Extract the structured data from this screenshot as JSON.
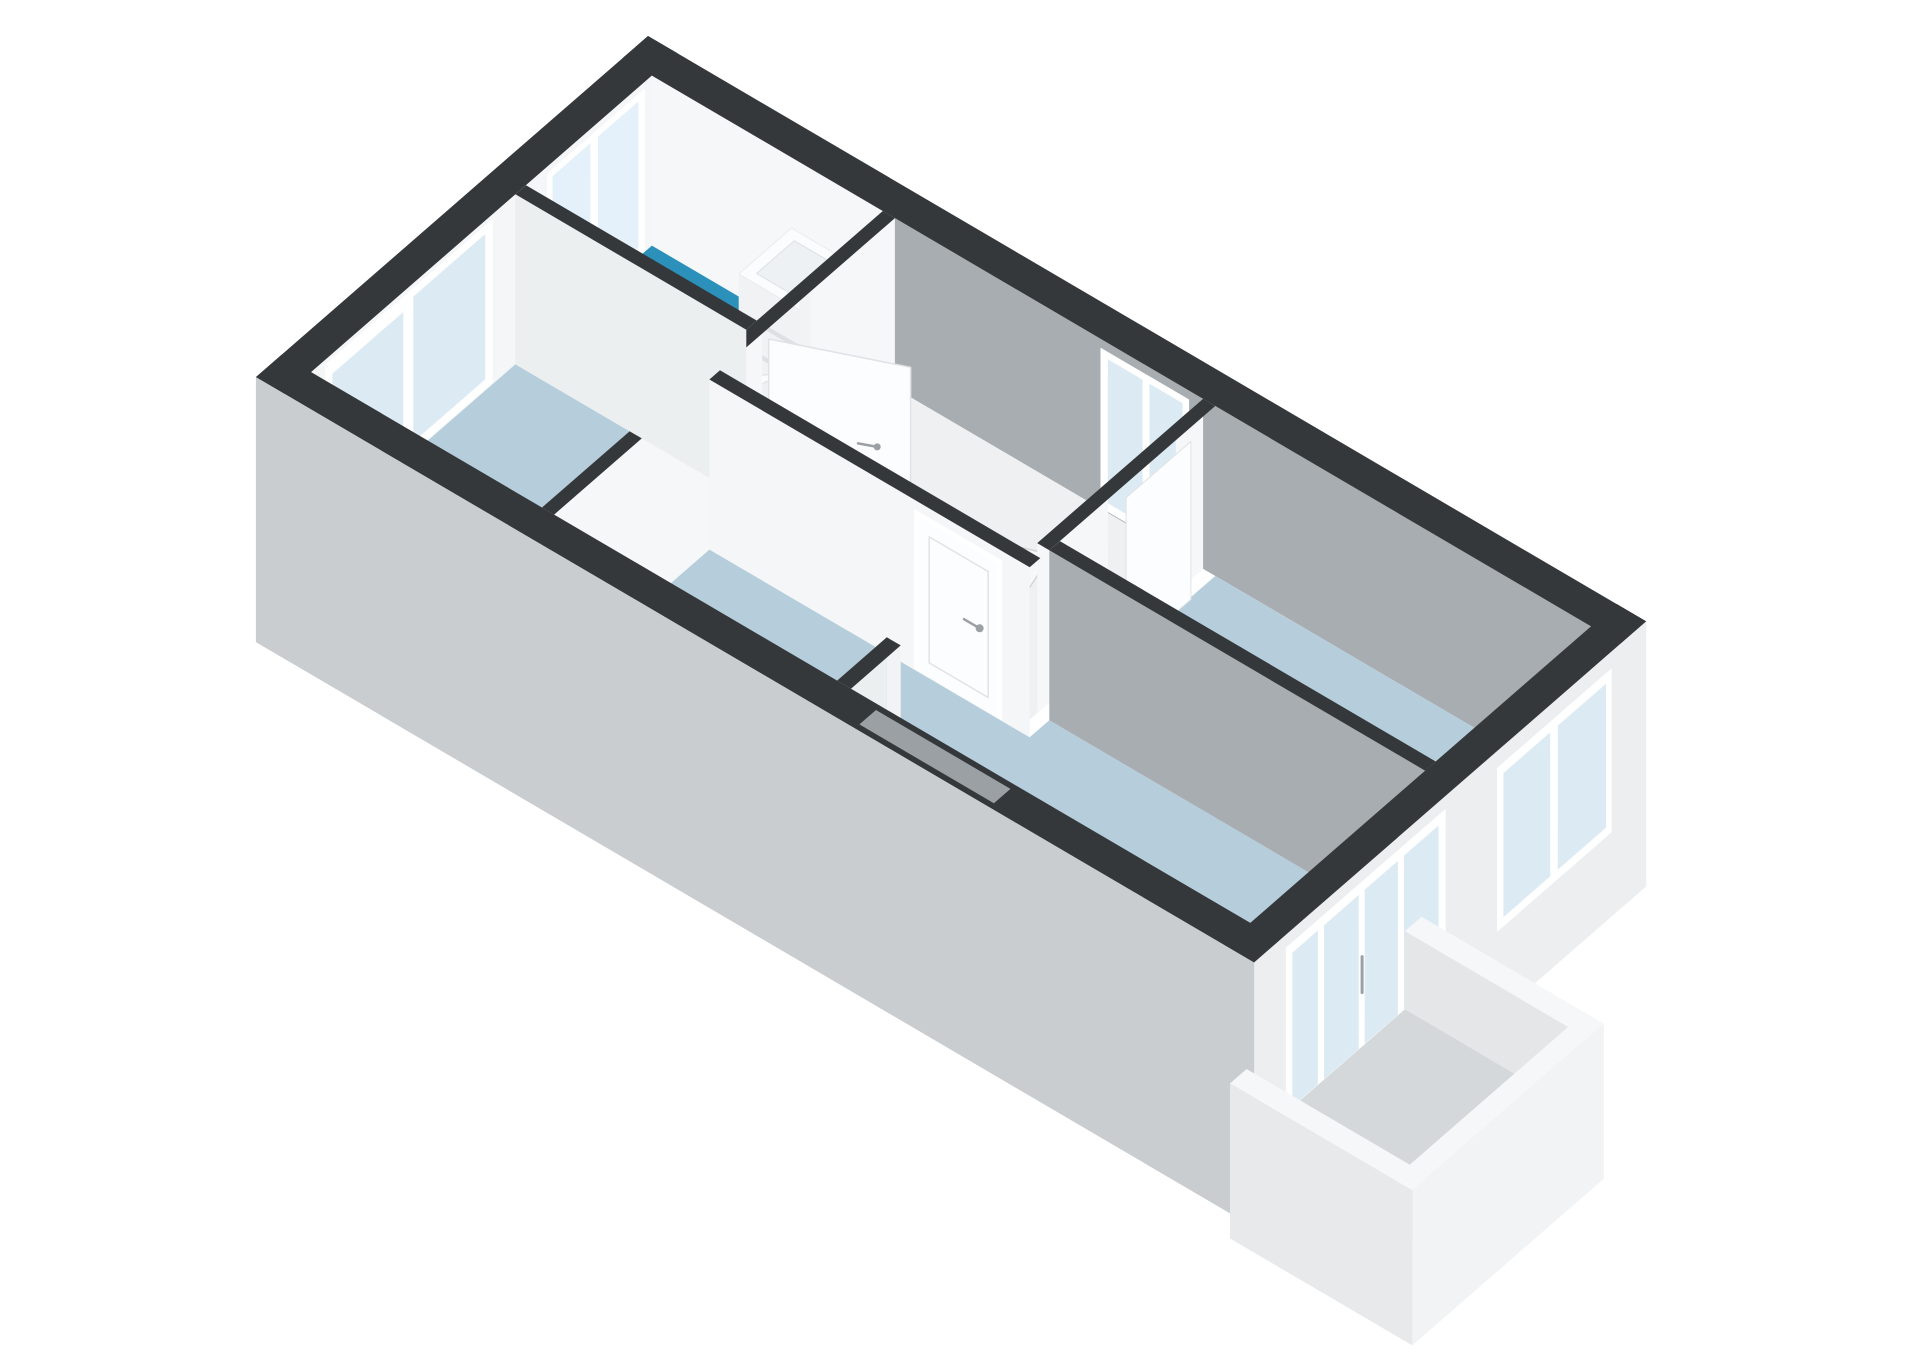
{
  "page": {
    "background": "#FFFFFF",
    "content_type": "3d-floorplan-render"
  },
  "floorplan": {
    "view": "axonometric-3d-cutaway",
    "rooms": [
      {
        "name": "bathroom",
        "floor_color_key": "floor_bathroom"
      },
      {
        "name": "landing-hall",
        "floor_color_key": "floor_hall"
      },
      {
        "name": "room-left",
        "floor_color_key": "floor_room"
      },
      {
        "name": "room-right",
        "floor_color_key": "floor_room"
      },
      {
        "name": "room-bottom",
        "floor_color_key": "floor_room"
      },
      {
        "name": "balcony",
        "floor_color_key": "floor_balcony"
      }
    ],
    "fixtures": [
      "bathtub",
      "vanity-sink",
      "toilet",
      "winder-staircase"
    ],
    "windows": [
      "bathroom-window",
      "left-room-window",
      "landing-window",
      "right-room-window",
      "balcony-glass-wall"
    ],
    "doors": [
      "bathroom-door-open",
      "right-room-door",
      "bottom-room-door-closed",
      "balcony-door"
    ],
    "colors": {
      "wall_top": "#35383B",
      "ext_sw": "#C9CDCF",
      "ext_se": "#ECEEEF",
      "inner_bright": "#F4F6F7",
      "inner_white": "#F6F7F8",
      "inner_white2": "#F1F3F4",
      "inner_gray": "#A8ADB1",
      "inner_gray2": "#C6CACD",
      "inner_soft": "#ECEFF0",
      "floor_room": "#B6CEDC",
      "floor_bathroom": "#2B90BA",
      "floor_hall": "#EEF0F1",
      "floor_balcony": "#D5D8DA",
      "glass": "#DCEBF3",
      "glass_frosted": "#E4F1FA",
      "window_frame": "#FFFFFF",
      "door_white": "#FCFDFE",
      "door_edge": "#E0E3E5",
      "stair": "#F7F8F9",
      "stair_edge": "#D2D5D7",
      "handle": "#9AA0A4",
      "furniture_top": "#FBFCFD",
      "furniture_front": "#F0F2F3",
      "furniture_side": "#E5E8EA",
      "furniture_line": "#DDE1E4",
      "basin": "#EDF1F3",
      "tub_side": "#EFF2F4",
      "tub_inner": "#F0F4F6",
      "niche": "#9BA0A4",
      "parapet_top": "#F6F7F8",
      "parapet_inner": "#E4E6E8",
      "parapet_outer": "#F1F3F4",
      "parapet_outer2": "#E7E9EB"
    }
  }
}
